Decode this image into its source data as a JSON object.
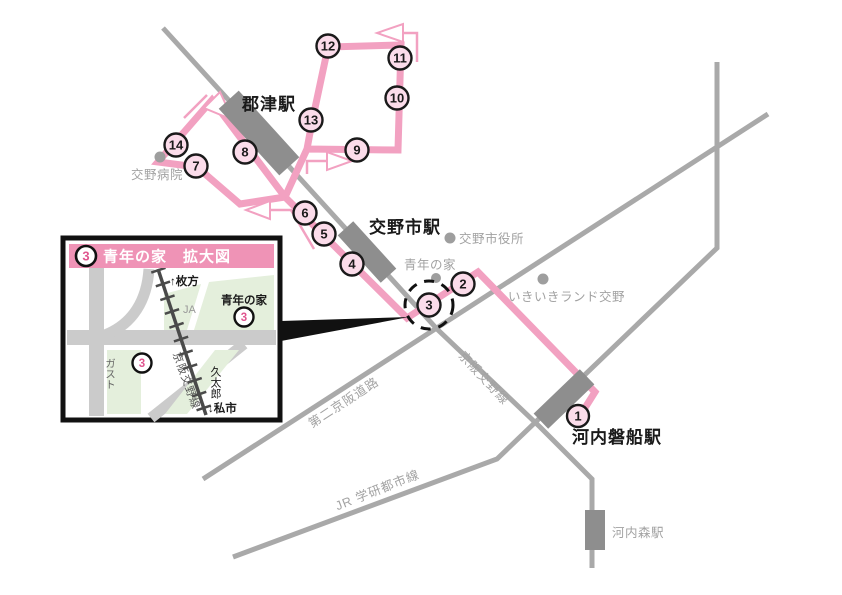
{
  "map": {
    "stations": {
      "kozu": "郡津駅",
      "katanoshi": "交野市駅",
      "kawachi_iwafune": "河内磐船駅",
      "kawachi_mori": "河内森駅"
    },
    "pois": {
      "katano_hospital": "交野病院",
      "city_hall": "交野市役所",
      "seinen_no_ie": "青年の家",
      "ikiiki_land": "いきいきランド交野"
    },
    "lines": {
      "keihan_katano": "京阪交野線",
      "jr_gakkentoshi": "JR 学研都市線",
      "daini_keihan": "第二京阪道路"
    },
    "stops": [
      "1",
      "2",
      "3",
      "4",
      "5",
      "6",
      "7",
      "8",
      "9",
      "10",
      "11",
      "12",
      "13",
      "14"
    ]
  },
  "inset": {
    "badge": "3",
    "title": "青年の家　拡大図",
    "labels": {
      "hirakata": "↑枚方",
      "kisaichi": "↓私市",
      "ja": "JA",
      "seinen_no_ie": "青年の家",
      "gusto": "ガスト",
      "kyutaro": "久太郎",
      "keihan_line": "京阪交野線",
      "stop_badge_1": "3",
      "stop_badge_2": "3"
    }
  },
  "colors": {
    "route_pink": "#F2A1C1",
    "stop_badge_fill": "#FBDCEA",
    "title_bar_pink": "#EF93B6",
    "line_gray": "#A9A9A9",
    "station_gray": "#8E8E8E",
    "text_gray": "#A2A2A2",
    "inset_green": "#E4EFDC",
    "inset_road_gray": "#CBCBCB",
    "inset_rail_dark": "#4A4A4A"
  }
}
